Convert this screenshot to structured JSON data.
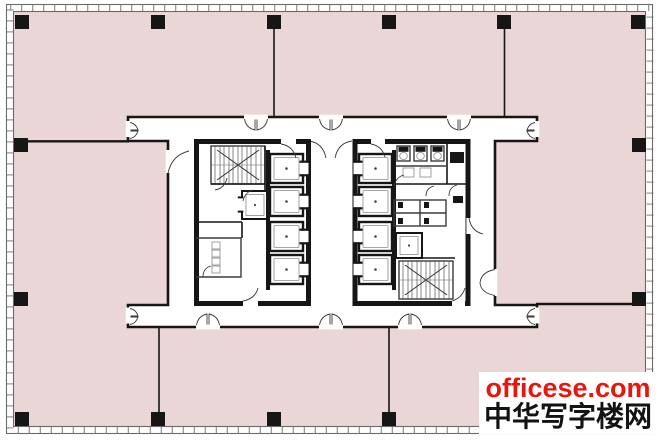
{
  "watermark": {
    "line1": "officese.com",
    "line2": "中华写字楼网"
  },
  "colors": {
    "floor_fill": "#ebd6d7",
    "wall": "#161616",
    "line": "#3a3a3a",
    "detail": "#8a8a8a",
    "border_tick": "#9a9a9a",
    "paper": "#ffffff",
    "watermark_red": "#e8170e",
    "watermark_dark": "#131313"
  }
}
